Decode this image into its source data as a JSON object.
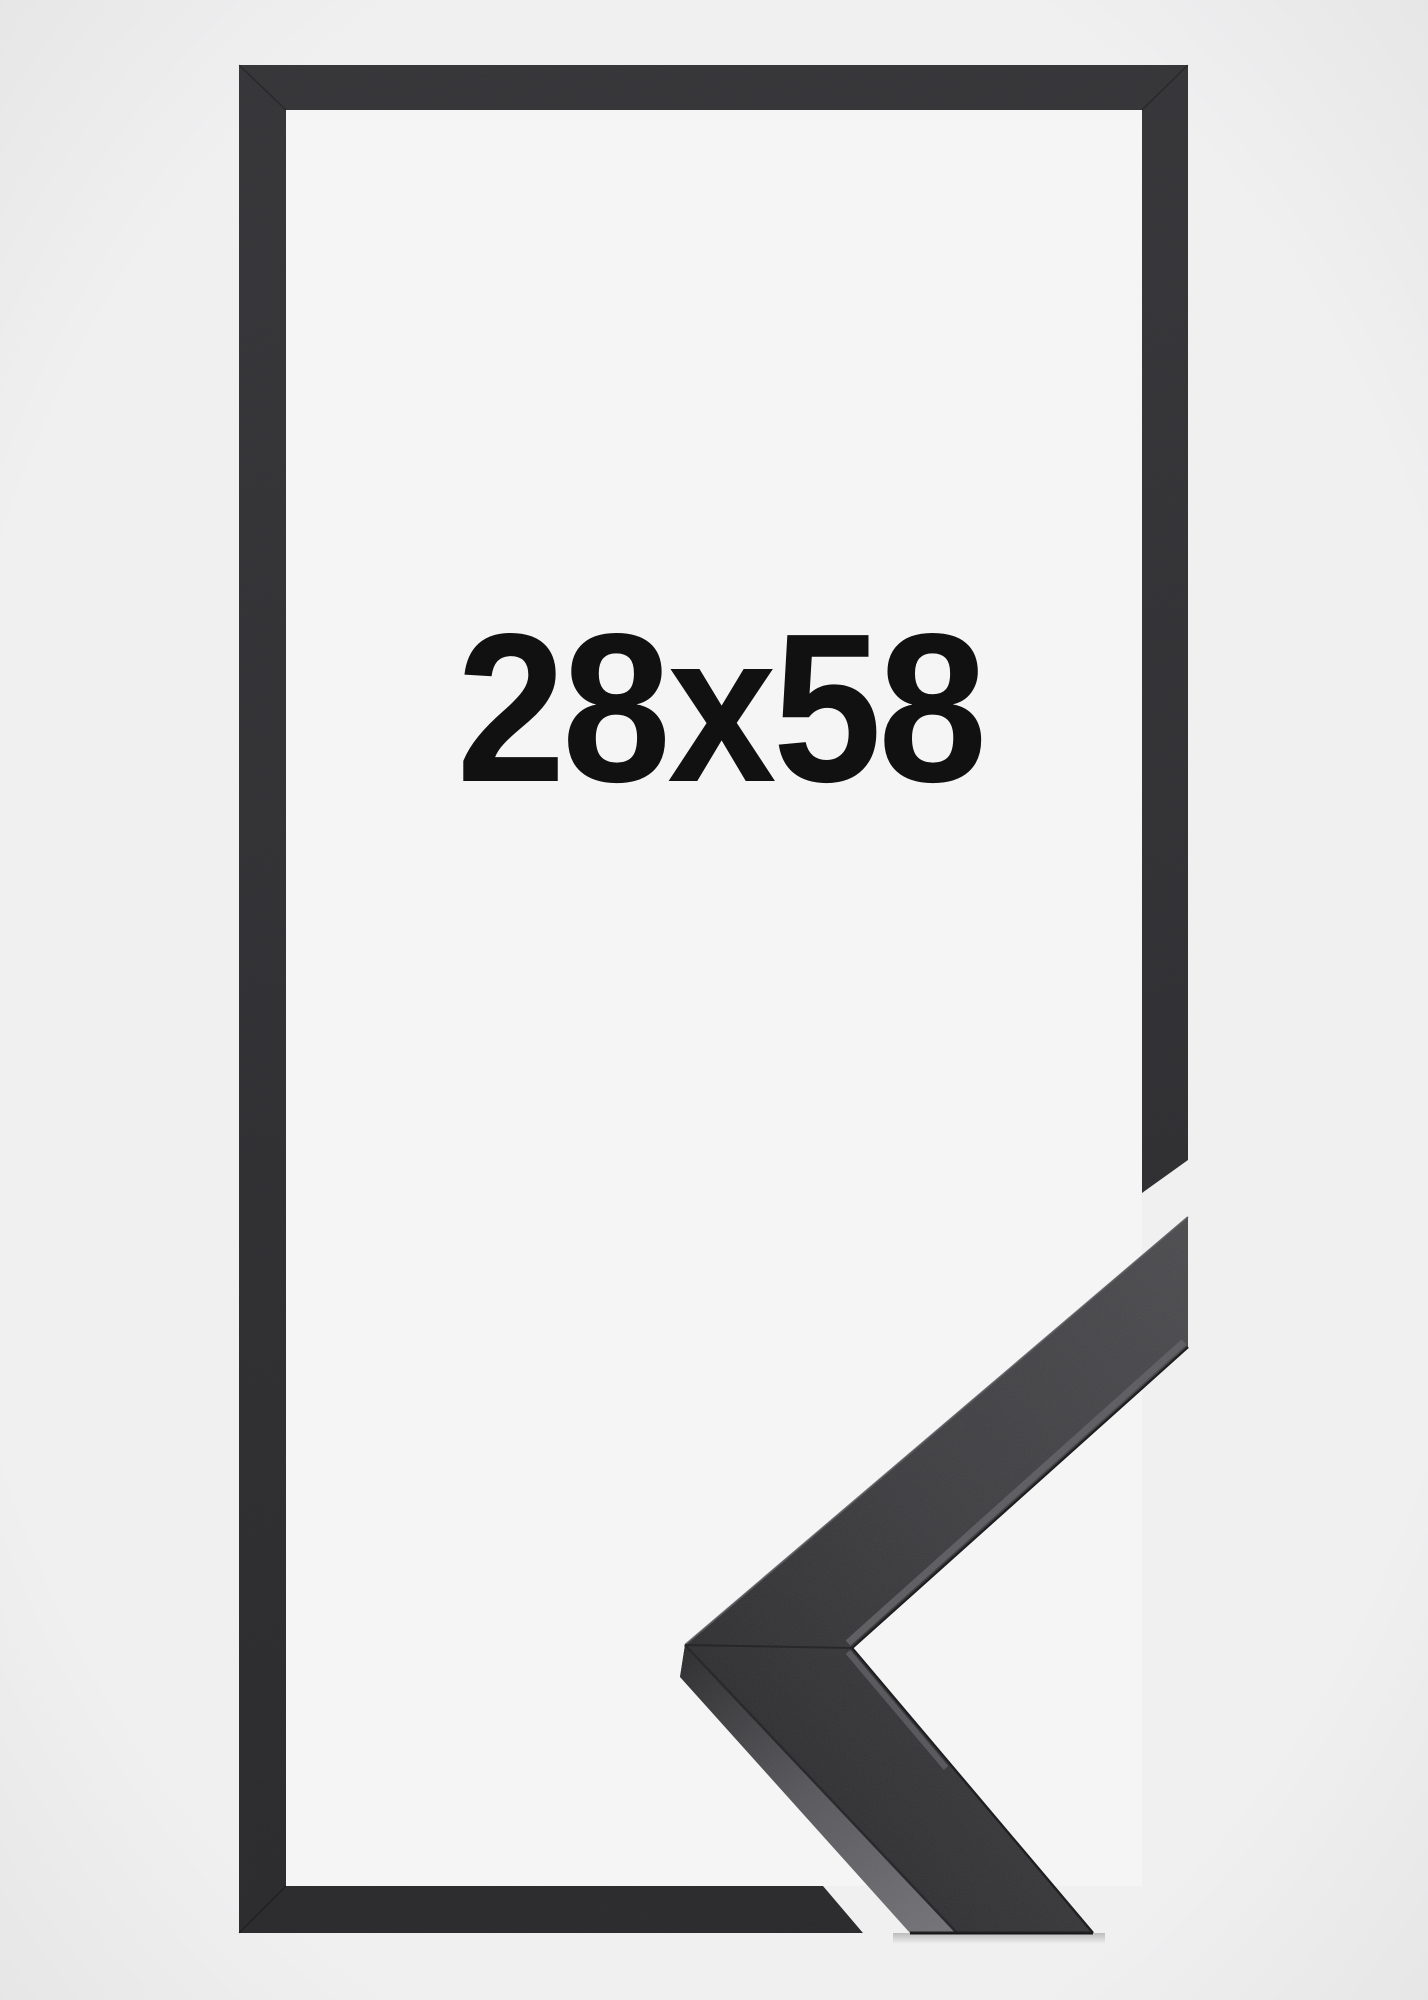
{
  "product": {
    "size_label": "28x58",
    "frame_color_name": "black",
    "colors": {
      "page_background": "#f0f0f1",
      "frame_interior": "#f5f5f6",
      "frame_outline_dark": "#303033",
      "moulding_face": "#3e3e41",
      "moulding_side_light": "#6a6a6e",
      "label_text": "#111111"
    }
  }
}
